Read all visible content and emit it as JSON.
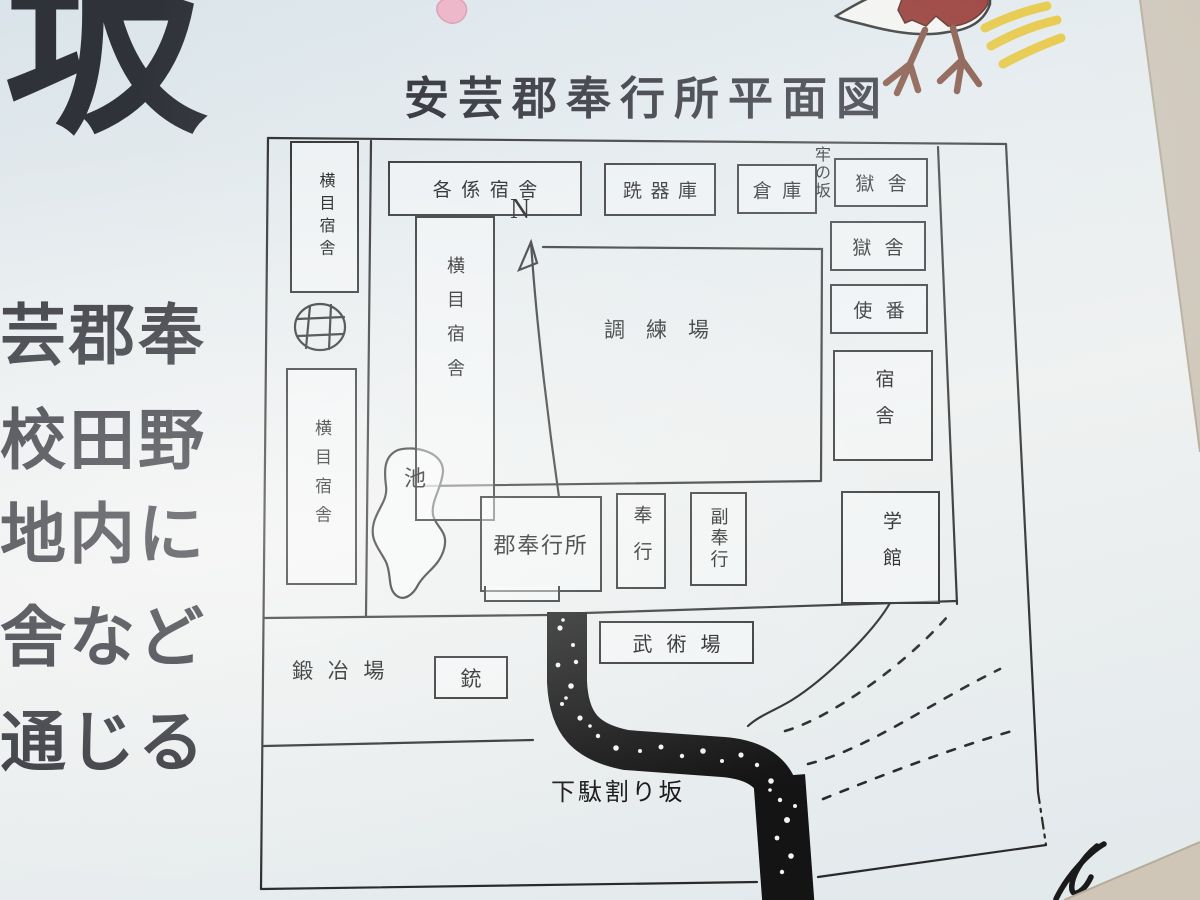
{
  "sign": {
    "title": "安芸郡奉行所平面図",
    "left_panel": {
      "big_char": "坂",
      "lines": [
        "芸郡奉",
        "校田野",
        "地内に",
        "舎など",
        "通じる"
      ]
    }
  },
  "map": {
    "north_indicator": "N",
    "buildings": {
      "yokome_shukusha": "横目宿舎",
      "kakugakari_shukusha": "各係宿舎",
      "senkiko": "跣器庫",
      "soko": "倉庫",
      "gokusha": "獄舎",
      "shiban": "使番",
      "shukusha": "宿舎",
      "gakkan": "学館",
      "chorenjo": "調練場",
      "gun_bugyosho": "郡奉行所",
      "bugyo": "奉行",
      "fuku_bugyo": "副奉行",
      "bujutsujo": "武術場",
      "kajiba": "鍛冶場",
      "ju": "銃"
    },
    "place_labels": {
      "ro_no_saka": "牢の坂",
      "ike": "池",
      "getawari_zaka": "下駄割り坂"
    }
  },
  "colors": {
    "line": "#2a2a2a",
    "road_black": "#141414",
    "bird_red": "#8f241e",
    "bird_leg_brown": "#7c4634",
    "motion_yellow": "#e7c32f",
    "petal_pink": "#edb0c3",
    "photo_edge_beige": "#cdc3b4",
    "sign_tint": "#e2e9ec"
  }
}
